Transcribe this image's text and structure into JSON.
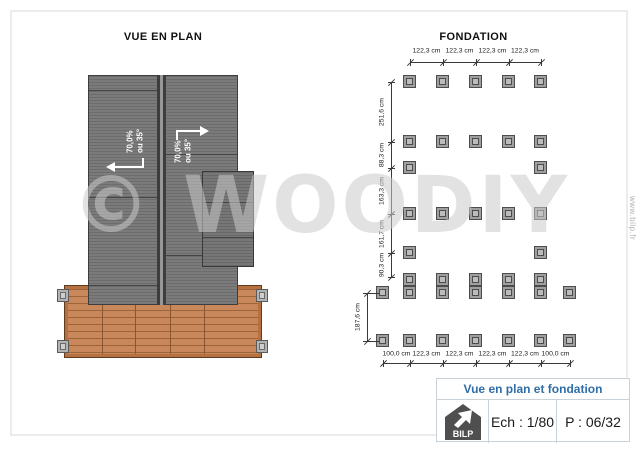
{
  "plan": {
    "title": "VUE EN PLAN",
    "slope": {
      "percent": "70,0%",
      "degrees": "ou 35°"
    }
  },
  "foundation": {
    "title": "FONDATION",
    "columns_x": [
      383,
      410,
      443,
      476,
      509,
      541,
      570
    ],
    "rows": [
      {
        "y": 82,
        "cols": [
          1,
          2,
          3,
          4,
          5
        ]
      },
      {
        "y": 142,
        "cols": [
          1,
          2,
          3,
          4,
          5
        ]
      },
      {
        "y": 168,
        "cols": [
          1,
          5
        ]
      },
      {
        "y": 214,
        "cols": [
          1,
          2,
          3,
          4,
          5
        ]
      },
      {
        "y": 253,
        "cols": [
          1,
          5
        ]
      },
      {
        "y": 280,
        "cols": [
          1,
          2,
          3,
          4,
          5
        ]
      },
      {
        "y": 293,
        "cols": [
          0,
          1,
          2,
          3,
          4,
          5,
          6
        ]
      },
      {
        "y": 341,
        "cols": [
          0,
          1,
          2,
          3,
          4,
          5,
          6
        ]
      }
    ],
    "dimensions": {
      "top": {
        "y": 62,
        "label_y": 51,
        "tick_cols": [
          1,
          2,
          3,
          4,
          5
        ],
        "labels": [
          "122,3 cm",
          "122,3 cm",
          "122,3 cm",
          "122,3 cm"
        ]
      },
      "bottom": {
        "y": 363,
        "label_y": 354,
        "tick_cols": [
          0,
          1,
          2,
          3,
          4,
          5,
          6
        ],
        "labels": [
          "100,0 cm",
          "122,3 cm",
          "122,3 cm",
          "122,3 cm",
          "122,3 cm",
          "100,0 cm"
        ]
      },
      "left": {
        "x": 391,
        "label_x": 382,
        "ticks_y": [
          82,
          142,
          168,
          214,
          253,
          277
        ],
        "labels": [
          "251,6 cm",
          "88,3 cm",
          "163,3 cm",
          "161,7 cm",
          "90,3 cm"
        ]
      },
      "outer_left": {
        "x": 367,
        "label_x": 358,
        "ticks_y": [
          293,
          341
        ],
        "labels": [
          "187,6 cm"
        ],
        "extensions_y": [
          293,
          341
        ]
      }
    }
  },
  "watermark": {
    "text": "© WOODIY",
    "side_text": "www.bilp.fr"
  },
  "title_block": {
    "title": "Vue en plan et fondation",
    "scale": "Ech : 1/80",
    "page": "P : 06/32",
    "logo": "BILP"
  },
  "colors": {
    "accent_blue": "#2f6da6",
    "roof_gray": "#787878",
    "wood": "#c9875c",
    "footing_gray": "#9f9f9f"
  }
}
